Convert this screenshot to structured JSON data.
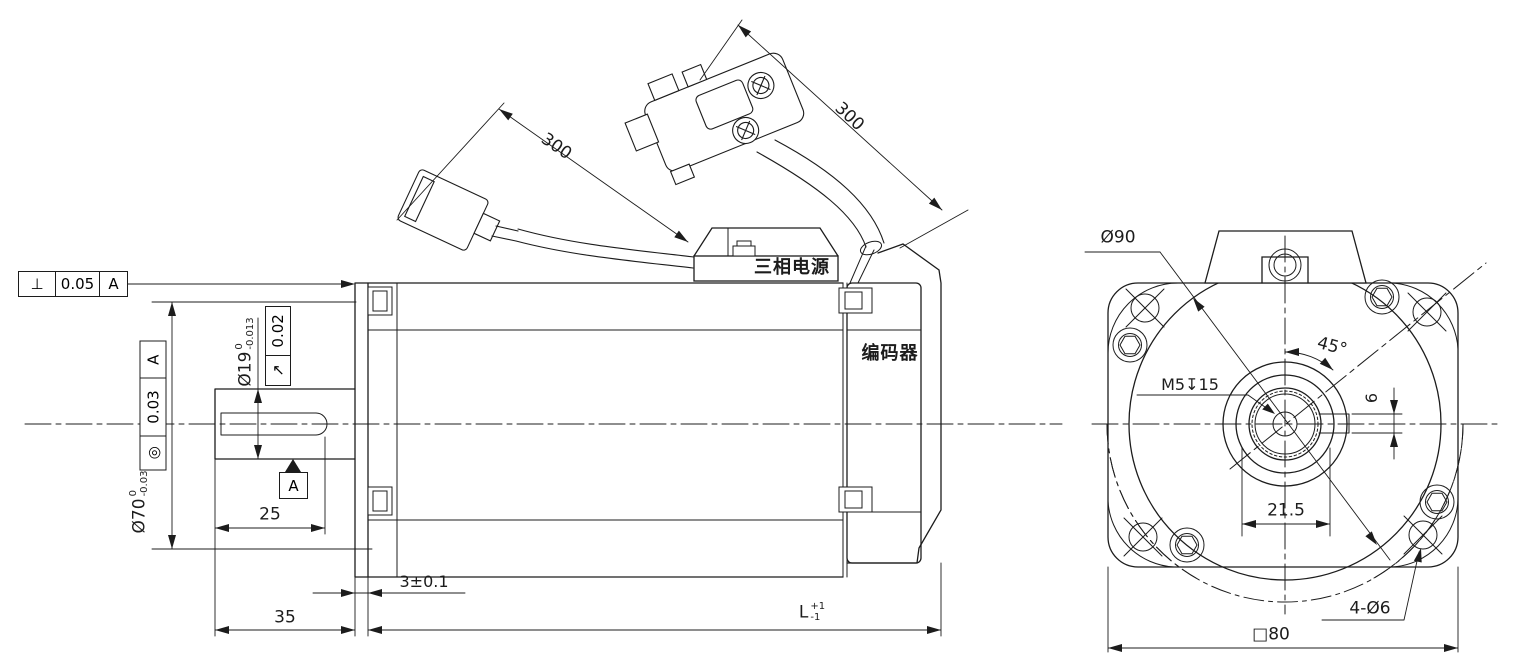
{
  "side_view": {
    "labels": {
      "power_connector": "三相电源",
      "encoder": "编码器"
    },
    "gdt": {
      "perpendicularity": {
        "symbol": "⊥",
        "tolerance": "0.05",
        "datum": "A"
      },
      "concentricity": {
        "symbol": "◎",
        "tolerance": "0.03",
        "datum": "A"
      },
      "circular_runout": {
        "symbol": "↗",
        "tolerance": "0.02"
      },
      "datum_flag": "A"
    },
    "dimensions": {
      "pilot_diameter": {
        "text": "Ø70",
        "sup": "0",
        "sub": "-0.03"
      },
      "shaft_diameter": {
        "text": "Ø19",
        "sup": "0",
        "sub": "-0.013"
      },
      "keyway_length": "25",
      "shaft_extension": "35",
      "flange_thickness": "3±0.1",
      "total_length": {
        "text": "L",
        "sup": "+1",
        "sub": "-1"
      },
      "power_cable_length": "300",
      "encoder_cable_length": "300"
    }
  },
  "front_view": {
    "dimensions": {
      "body_diameter": "Ø90",
      "mount_hole_angle": "45°",
      "shaft_end_tap": "M5↧15",
      "keyway_width": "6",
      "shaft_boss_width": "21.5",
      "mounting_holes": "4-Ø6",
      "flange_square": "□80"
    }
  }
}
